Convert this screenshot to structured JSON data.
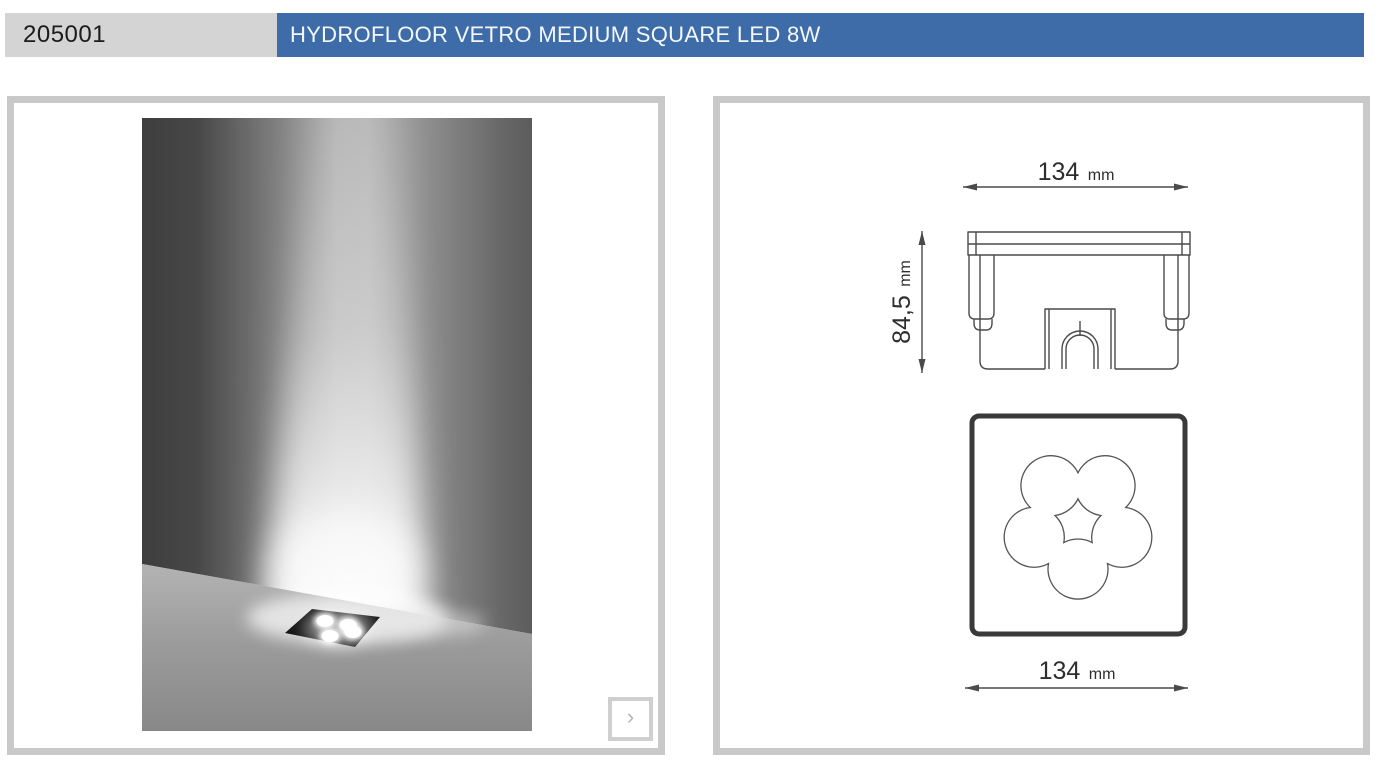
{
  "header": {
    "product_code": "205001",
    "product_title": "HYDROFLOOR VETRO MEDIUM SQUARE LED 8W"
  },
  "gallery": {
    "next_label": "›"
  },
  "drawing": {
    "top_width": {
      "value": "134",
      "unit": "mm"
    },
    "side_height": {
      "value": "84,5",
      "unit": "mm"
    },
    "bottom_width": {
      "value": "134",
      "unit": "mm"
    }
  },
  "colors": {
    "accent_blue": "#3e6ca8",
    "code_bg": "#d4d4d4",
    "panel_border": "#c9c9c9",
    "drawing_line": "#4a4a4a"
  }
}
